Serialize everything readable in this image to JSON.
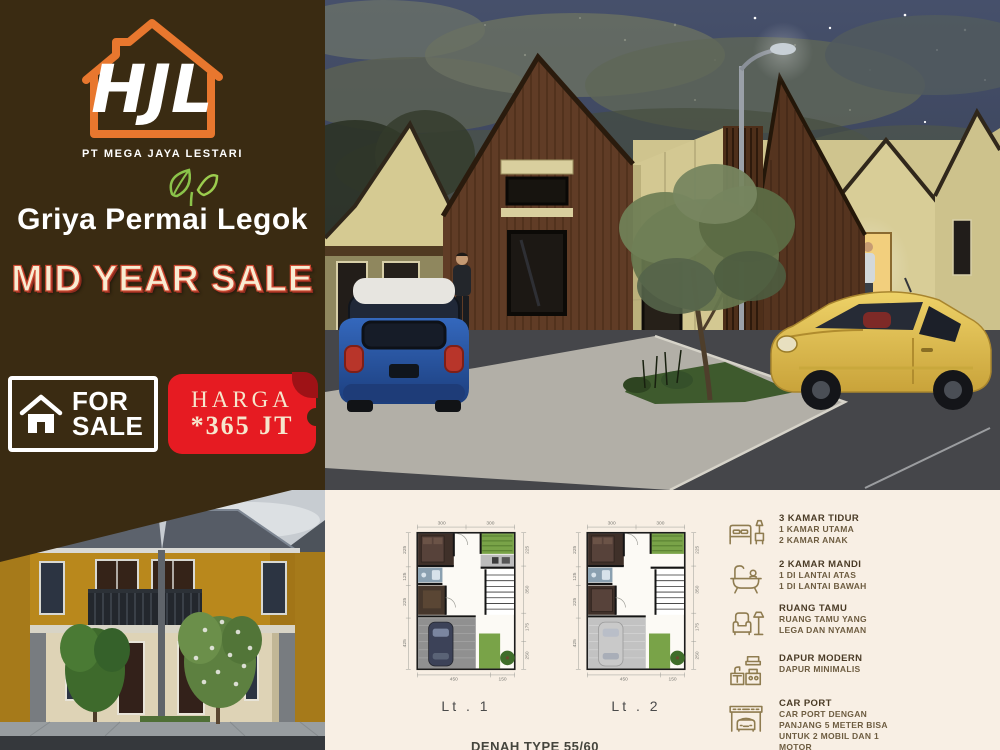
{
  "brand": {
    "monogram": "HJL",
    "company": "PT MEGA JAYA LESTARI",
    "project": "Griya Permai Legok"
  },
  "promo": {
    "headline": "MID YEAR SALE",
    "for_sale": {
      "line1": "FOR",
      "line2": "SALE"
    },
    "price": {
      "label": "HARGA",
      "value": "*365 JT"
    }
  },
  "plans": {
    "plan1_label": "Lt . 1",
    "plan2_label": "Lt . 2",
    "caption": "DENAH TYPE 55/60",
    "dims": {
      "top": [
        "300",
        "300"
      ],
      "left": [
        "225",
        "125",
        "225",
        "425"
      ],
      "right": [
        "225",
        "350",
        "175",
        "250"
      ],
      "bottom": [
        "450",
        "150"
      ]
    }
  },
  "features": [
    {
      "icon": "bed-icon",
      "title": "3 KAMAR TIDUR",
      "lines": [
        "1 KAMAR UTAMA",
        "2 KAMAR ANAK"
      ]
    },
    {
      "icon": "bathtub-icon",
      "title": "2 KAMAR MANDI",
      "lines": [
        "1 DI LANTAI ATAS",
        "1 DI LANTAI BAWAH"
      ]
    },
    {
      "icon": "sofa-icon",
      "title": "RUANG TAMU",
      "lines": [
        "RUANG TAMU YANG",
        "LEGA DAN NYAMAN"
      ]
    },
    {
      "icon": "kitchen-icon",
      "title": "DAPUR MODERN",
      "lines": [
        "DAPUR MINIMALIS"
      ]
    },
    {
      "icon": "carport-icon",
      "title": "CAR PORT",
      "lines": [
        "CAR PORT DENGAN",
        "PANJANG 5 METER BISA",
        "UNTUK 2 MOBIL DAN 1",
        "MOTOR"
      ]
    }
  ],
  "colors": {
    "panel_brown": "#3a2b12",
    "accent_orange": "#e8772e",
    "tag_red": "#e61b22",
    "headline_cream": "#f8ecd2",
    "plans_panel_cream": "#f8efe4",
    "leaf_green": "#8bc34a"
  }
}
